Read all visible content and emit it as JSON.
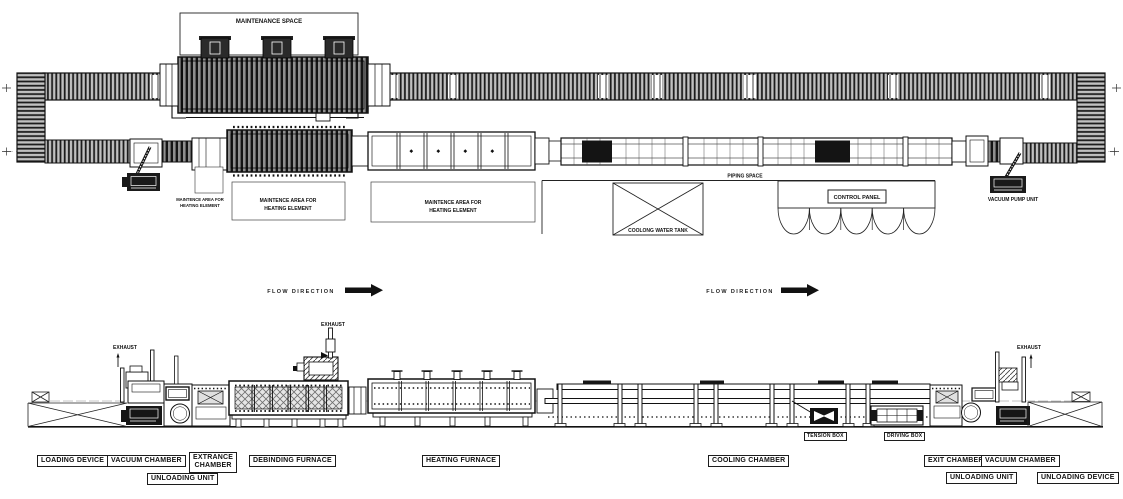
{
  "plan": {
    "maintenance_space": "MAINTENANCE SPACE",
    "maintence_area_line1": "MAINTENCE AREA FOR",
    "maintence_area_line2": "HEATING ELEMENT",
    "cooling_water_tank": "COOLONG WATER TANK",
    "piping_space": "PIPING SPACE",
    "control_panel": "CONTROL PANEL",
    "vacuum_pump_unit": "VACUUM PUMP UNIT"
  },
  "flow_direction": {
    "label": "FLOW DIRECTION"
  },
  "elevation": {
    "exhaust": "EXHAUST",
    "loading_device": "LOADING DEVICE",
    "vacuum_chamber": "VACUUM CHAMBER",
    "extrance_chamber_line1": "EXTRANCE",
    "extrance_chamber_line2": "CHAMBER",
    "unloading_unit": "UNLOADING UNIT",
    "debinding_furnace": "DEBINDING FURNACE",
    "heating_furnace": "HEATING FURNACE",
    "cooling_chamber": "COOLING CHAMBER",
    "tension_box": "TENSION BOX",
    "driving_box": "DRIVING BOX",
    "exit_chamber": "EXIT CHAMBER",
    "unloading_device": "UNLOADING DEVICE"
  },
  "colors": {
    "ink": "#1a1a1a",
    "paper": "#ffffff",
    "hatch_gray": "#8f8f8f",
    "block_dark": "#141414"
  }
}
